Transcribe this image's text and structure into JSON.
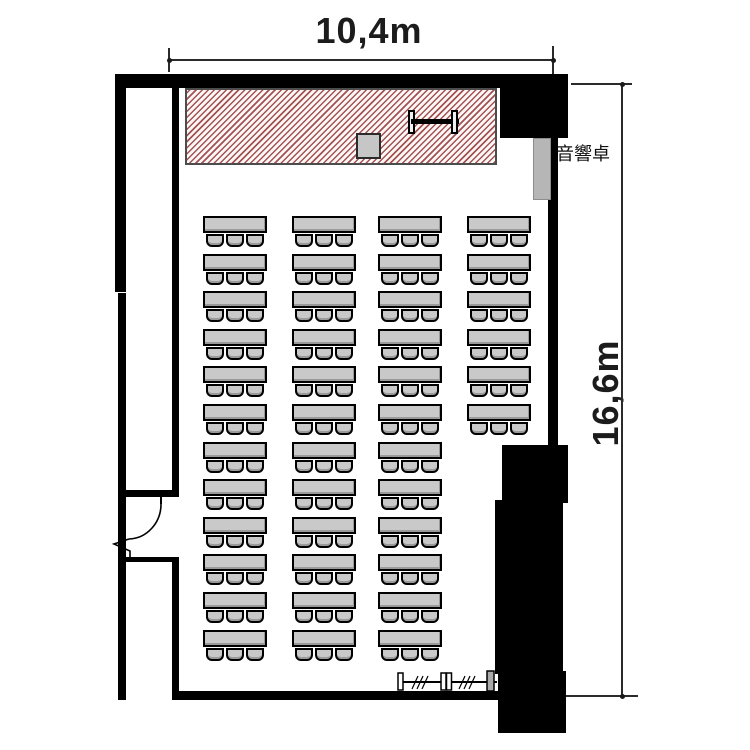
{
  "title": "seminar-room-floor-plan",
  "dimensions": {
    "width_label": "10,4m",
    "height_label": "16,6m"
  },
  "labels": {
    "sound_console": "音響卓"
  },
  "stage": {
    "name": "stage (hatched platform)",
    "items": [
      "podium",
      "whiteboard-screen"
    ]
  },
  "furniture": {
    "desk_columns": [
      {
        "x": 203,
        "rows": 12
      },
      {
        "x": 292,
        "rows": 12
      },
      {
        "x": 378,
        "rows": 12
      },
      {
        "x": 467,
        "rows": 6
      }
    ],
    "row_start_y": 216,
    "row_pitch": 37.6,
    "desk": {
      "w": 64,
      "h": 17
    },
    "chair": {
      "w": 18,
      "h": 13,
      "offsets": [
        3,
        23,
        43
      ],
      "per_desk": 3
    },
    "total_desks": 42,
    "total_seats": 126
  },
  "colors": {
    "wall": "#000000",
    "stage_hatch": "#a35252",
    "desk_fill": "#c9c9c9",
    "console_fill": "#b6b6b6"
  }
}
